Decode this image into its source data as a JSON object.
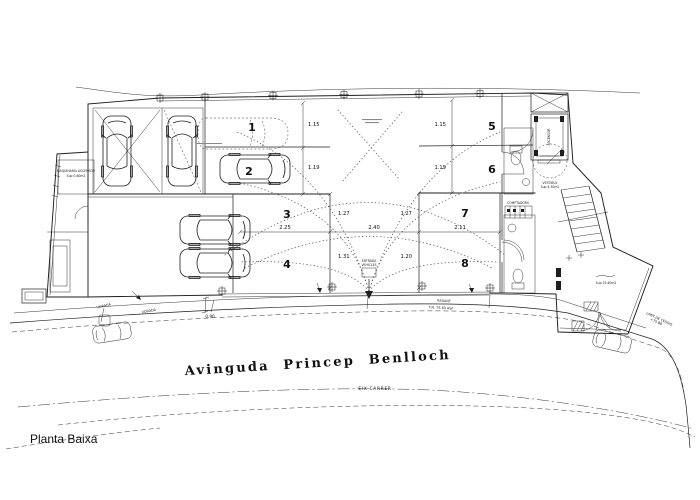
{
  "drawing_title": "Planta Baixa",
  "street": {
    "name": "Avinguda Princep Benlloch",
    "axis_label": "EIX CARRER"
  },
  "parking": {
    "spaces": [
      "1",
      "2",
      "3",
      "4",
      "5",
      "6",
      "7",
      "8"
    ]
  },
  "dimensions": {
    "bay1_left": "1.15",
    "bay2_left": "1.19",
    "bay1_right": "1.15",
    "bay2_right": "1.19",
    "aisle_top_left": "1.27",
    "aisle_top_right": "1.27",
    "aisle_bottom_left": "1.31",
    "aisle_bottom_right": "1.20",
    "width_left": "2.25",
    "width_center": "2.40",
    "width_right": "2.11",
    "sidewalk": "0.90"
  },
  "annotations": {
    "machinery_line1": "MAQUINARIA ASCENSOR",
    "machinery_line2": "Sup 0.80m2",
    "elevator": "ASCENSOR",
    "vestibule_line1": "VESTIBUL",
    "vestibule_line2": "Sup 4.50m2",
    "meters": "COMPTADORS",
    "entrance_line1": "ENTRADA",
    "entrance_line2": "VEHICLES",
    "patio_area": "Sup 25.40m2",
    "curb_label_1": "VORADA",
    "curb_label_2": "VORADA",
    "grade_label": "RASANT",
    "level_label": "T.N. 75.60 ASF",
    "limit_line1": "LIMIT DE CESSIO",
    "limit_line2": "+75.88"
  },
  "palette": {
    "line": "#1f1f1f",
    "dotted": "#5f5f5f",
    "background": "#ffffff"
  }
}
